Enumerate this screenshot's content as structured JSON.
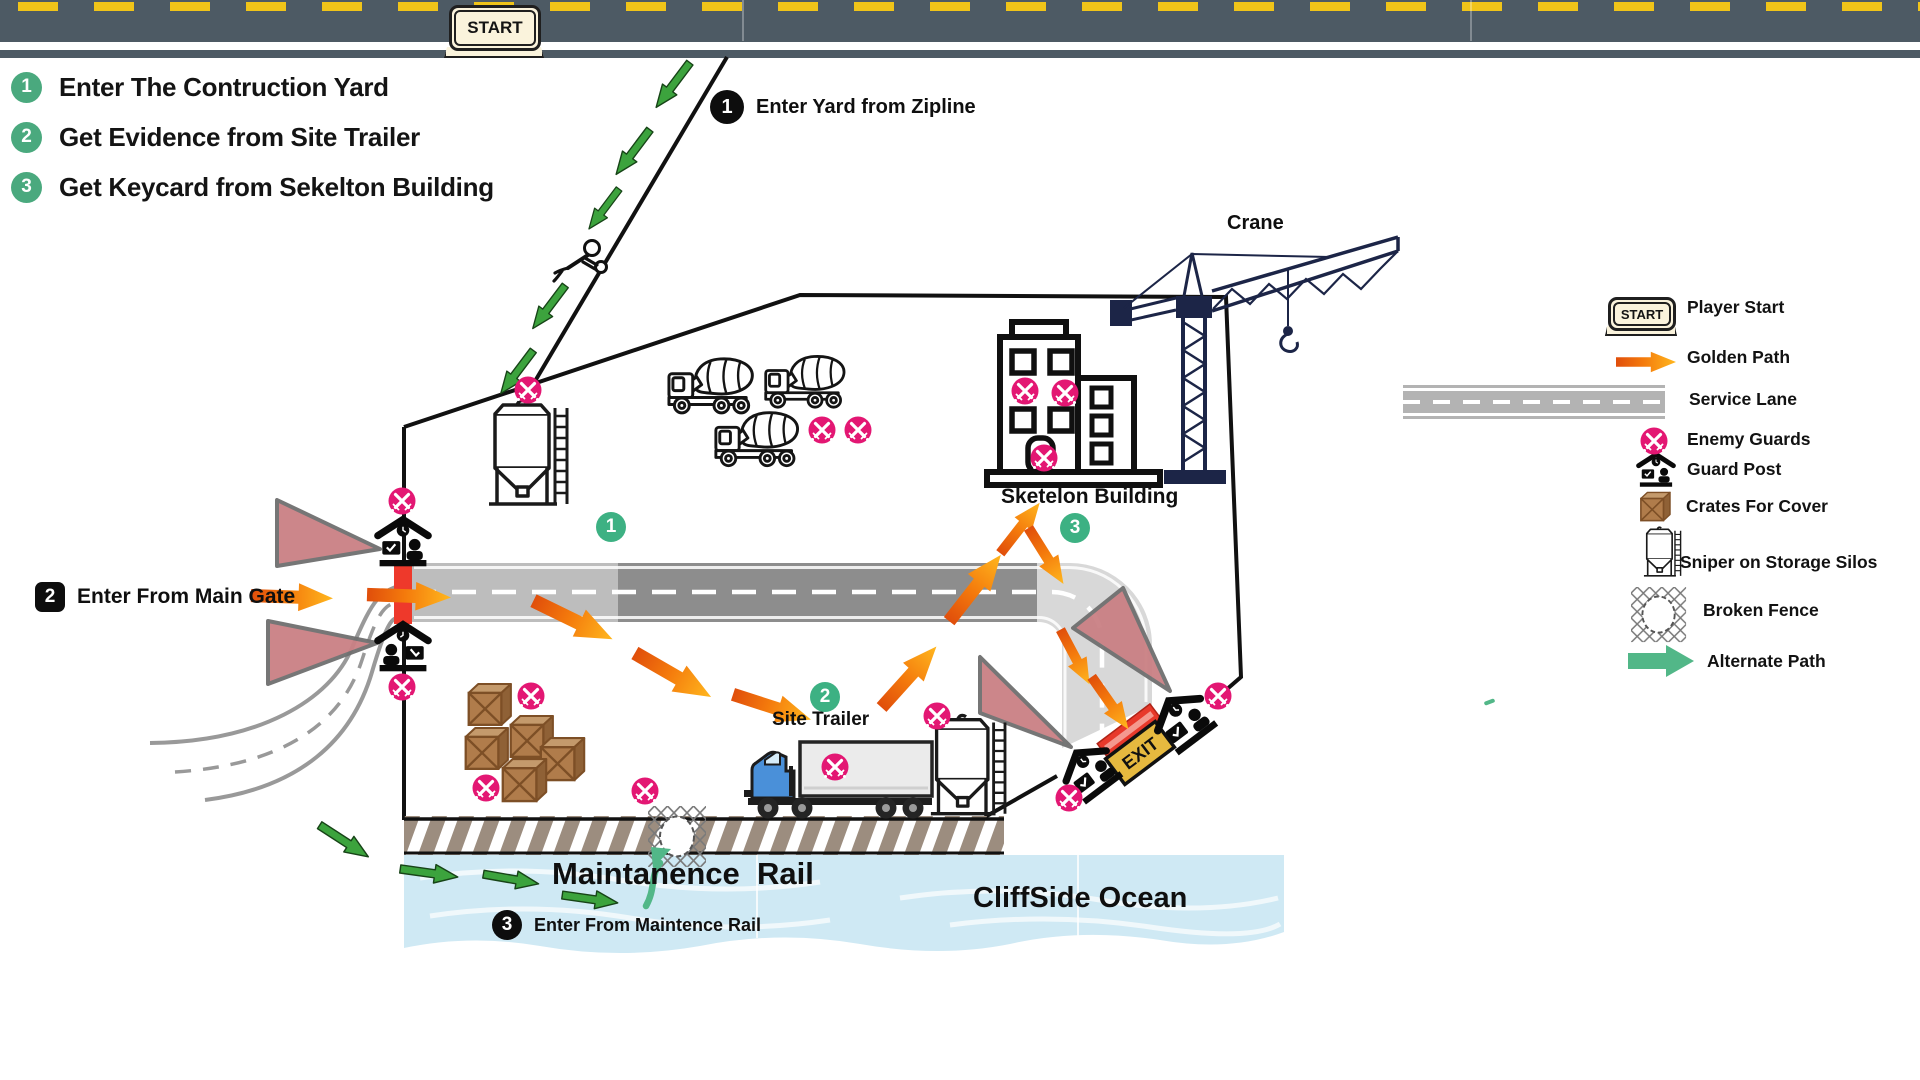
{
  "start_key": {
    "label": "START"
  },
  "objectives": [
    {
      "num": "1",
      "text": "Enter The Contruction Yard"
    },
    {
      "num": "2",
      "text": "Get Evidence from Site Trailer"
    },
    {
      "num": "3",
      "text": "Get Keycard from Sekelton Building"
    }
  ],
  "entry_points": [
    {
      "num": "1",
      "badge": "circle",
      "text": "Enter Yard from Zipline"
    },
    {
      "num": "2",
      "badge": "square",
      "text": "Enter From Main Gate"
    },
    {
      "num": "3",
      "badge": "circle",
      "text": "Enter From Maintence Rail"
    }
  ],
  "area_markers": [
    {
      "num": "1",
      "x": 611,
      "y": 527
    },
    {
      "num": "2",
      "x": 825,
      "y": 697
    },
    {
      "num": "3",
      "x": 1075,
      "y": 528
    }
  ],
  "map_labels": {
    "crane": "Crane",
    "sketelon_building": "Sketelon Building",
    "site_trailer": "Site Trailer",
    "maintanence_rail": "Maintanence  Rail",
    "cliffside_ocean": "CliffSide Ocean",
    "exit": "EXIT"
  },
  "legend": [
    {
      "icon": "start-key",
      "label": "Player Start"
    },
    {
      "icon": "golden-path-arrow",
      "label": "Golden Path"
    },
    {
      "icon": "service-lane-swatch",
      "label": "Service Lane"
    },
    {
      "icon": "enemy-guard-badge",
      "label": "Enemy Guards"
    },
    {
      "icon": "guard-post",
      "label": "Guard Post"
    },
    {
      "icon": "crate",
      "label": "Crates For Cover"
    },
    {
      "icon": "storage-silo",
      "label": "Sniper on Storage Silos"
    },
    {
      "icon": "broken-fence",
      "label": "Broken Fence"
    },
    {
      "icon": "alternate-path-arrow",
      "label": "Alternate Path"
    }
  ],
  "enemy_guards": [
    {
      "x": 528,
      "y": 390
    },
    {
      "x": 822,
      "y": 430
    },
    {
      "x": 858,
      "y": 430
    },
    {
      "x": 531,
      "y": 696
    },
    {
      "x": 486,
      "y": 788
    },
    {
      "x": 645,
      "y": 791
    },
    {
      "x": 402,
      "y": 501
    },
    {
      "x": 402,
      "y": 687
    },
    {
      "x": 835,
      "y": 767
    },
    {
      "x": 937,
      "y": 716
    },
    {
      "x": 1218,
      "y": 696
    },
    {
      "x": 1069,
      "y": 798
    },
    {
      "x": 1025,
      "y": 391
    },
    {
      "x": 1065,
      "y": 393
    },
    {
      "x": 1044,
      "y": 458
    }
  ],
  "golden_path": [
    {
      "x": 292,
      "y": 597,
      "deg": 2,
      "len": 82
    },
    {
      "x": 409,
      "y": 596,
      "deg": 2,
      "len": 84
    },
    {
      "x": 573,
      "y": 620,
      "deg": 26,
      "len": 88
    },
    {
      "x": 673,
      "y": 675,
      "deg": 30,
      "len": 88
    },
    {
      "x": 772,
      "y": 707,
      "deg": 18,
      "len": 82
    },
    {
      "x": 909,
      "y": 677,
      "deg": -48,
      "len": 82
    },
    {
      "x": 975,
      "y": 588,
      "deg": -52,
      "len": 84
    },
    {
      "x": 1020,
      "y": 528,
      "deg": -52,
      "len": 64
    },
    {
      "x": 1046,
      "y": 556,
      "deg": 58,
      "len": 66
    },
    {
      "x": 1075,
      "y": 657,
      "deg": 62,
      "len": 62
    },
    {
      "x": 1110,
      "y": 703,
      "deg": 55,
      "len": 64
    }
  ],
  "alternate_path": {
    "zipline": [
      {
        "x": 673,
        "y": 85,
        "deg": 127,
        "len": 56
      },
      {
        "x": 633,
        "y": 152,
        "deg": 127,
        "len": 56
      },
      {
        "x": 604,
        "y": 209,
        "deg": 127,
        "len": 50
      },
      {
        "x": 549,
        "y": 307,
        "deg": 127,
        "len": 54
      },
      {
        "x": 517,
        "y": 372,
        "deg": 127,
        "len": 54
      }
    ],
    "rail": [
      {
        "x": 344,
        "y": 841,
        "deg": 33,
        "len": 58
      },
      {
        "x": 429,
        "y": 873,
        "deg": 8,
        "len": 58
      },
      {
        "x": 511,
        "y": 879,
        "deg": 10,
        "len": 56
      },
      {
        "x": 590,
        "y": 899,
        "deg": 8,
        "len": 56
      }
    ]
  },
  "legend_icons": {
    "golden": {
      "x": 1646,
      "y": 362,
      "deg": 0,
      "len": 60
    },
    "enemy": {
      "x": 1654,
      "y": 441
    }
  },
  "colors": {
    "golden_tail": "#e04e0b",
    "golden_head": "#ffb71e",
    "alternate_green": "#3ca33d",
    "alternate_teal": "#52b788",
    "enemy_pink": "#e31773",
    "marker_green": "#3db183",
    "objective_green": "#4aa97e",
    "vision_cone": "#ca8084",
    "water_blue": "#cfe9f4",
    "top_road": "#4d5a64",
    "lane_light": "#d8d8d8",
    "lane_mid": "#bdbdbd",
    "lane_dark": "#8d8d8d",
    "crane_navy": "#1c2547",
    "gate_red": "#ee392b",
    "exit_yellow": "#e6b93f",
    "crate_brown": "#b07c4b"
  }
}
